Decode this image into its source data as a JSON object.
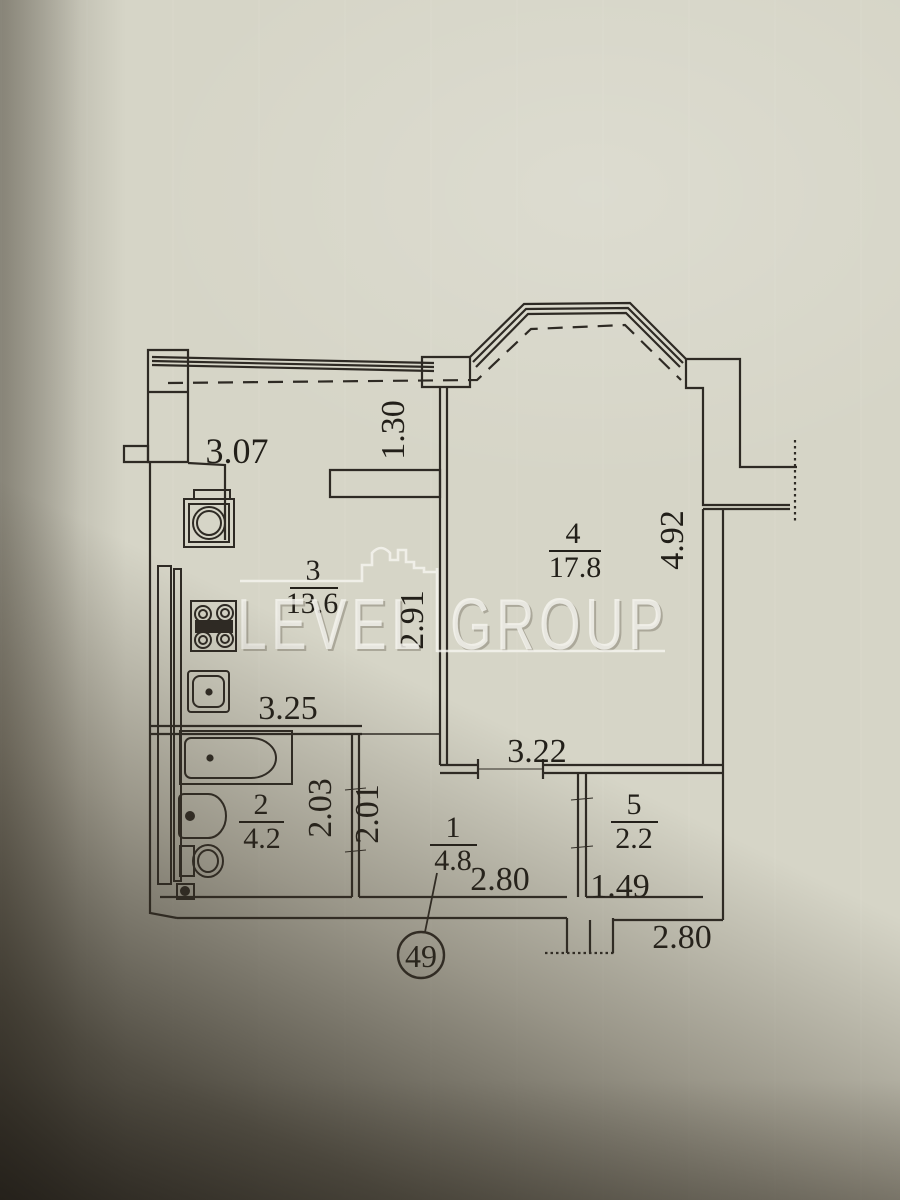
{
  "watermark": {
    "left": "LEVEL",
    "right": "GROUP"
  },
  "apartment": {
    "number": "49"
  },
  "rooms": [
    {
      "number": "1",
      "area": "4.8"
    },
    {
      "number": "2",
      "area": "4.2"
    },
    {
      "number": "3",
      "area": "13.6"
    },
    {
      "number": "4",
      "area": "17.8"
    },
    {
      "number": "5",
      "area": "2.2"
    }
  ],
  "dimensions": {
    "kitchen_top_width": "3.07",
    "loggia_depth": "1.30",
    "kitchen_width": "3.25",
    "kitchen_depth": "2.91",
    "room4_depth": "4.92",
    "room4_bottom_width": "3.22",
    "bathroom_depth": "2.03",
    "hallway_depth": "2.01",
    "hallway_width": "2.80",
    "room5_width": "1.49",
    "entrance_width": "2.80"
  },
  "colors": {
    "paper": "#d6d5c7",
    "ink": "#2e2a24",
    "watermark": "#f6f5f0"
  }
}
